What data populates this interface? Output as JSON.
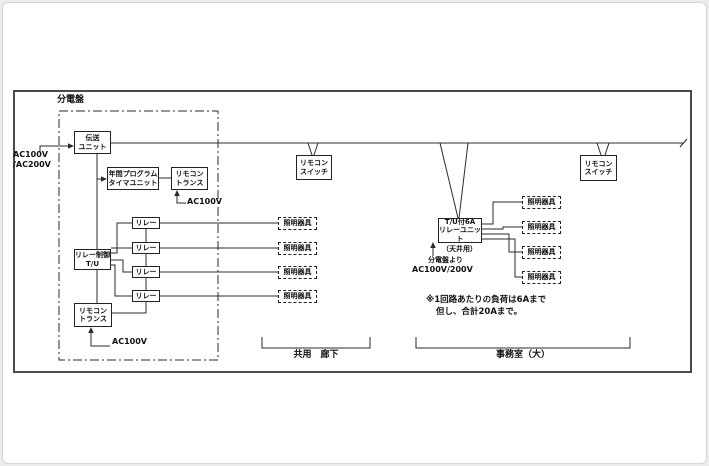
{
  "panel": {
    "label": "分電盤"
  },
  "feeds": {
    "main": "AC100V\n/AC200V",
    "ac100v": "AC100V",
    "sub_source": "分電盤より",
    "sub_voltage": "AC100V/200V"
  },
  "units": {
    "transmission": "伝送\nユニット",
    "timer": "年間プログラム\nタイマユニット",
    "remocon_trans": "リモコン\nトランス",
    "relay_control": "リレー制御\nT/U",
    "relay": "リレー",
    "remocon_switch": "リモコン\nスイッチ",
    "light": "照明器具",
    "relay_unit_6a": "T/U付6A\nリレーユニット",
    "relay_unit_sub": "（天井用）"
  },
  "notes": {
    "line1": "※1回路あたりの負荷は6Aまで",
    "line2": "但し、合計20Aまで。"
  },
  "areas": {
    "left": "共用　廊下",
    "right": "事務室（大）"
  },
  "colors": {
    "line": "#2b2b2b",
    "frame": "#4a4a4a",
    "background": "#ffffff"
  }
}
